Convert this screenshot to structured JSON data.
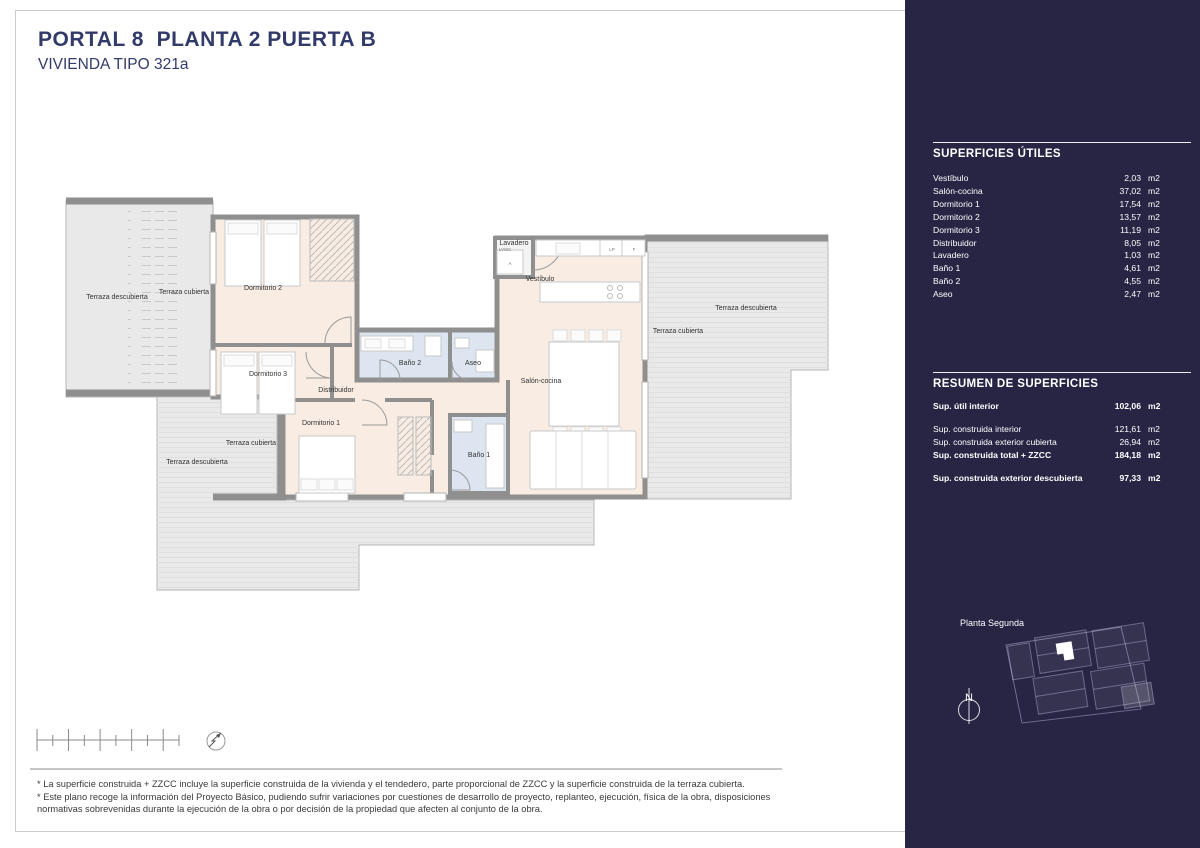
{
  "colors": {
    "navy": "#323a69",
    "sidebar": "#272444",
    "peach": "#f8ece3",
    "wet": "#dce5f0",
    "terrace": "#e9e9e9",
    "wall": "#8f8f8f"
  },
  "header": {
    "title": "PORTAL 8  PLANTA 2 PUERTA B",
    "subtitle": "VIVIENDA TIPO 321a"
  },
  "plan": {
    "room_labels": [
      {
        "id": "terraza-descubierta-nw",
        "text": "Terraza descubierta",
        "x": 117,
        "y": 299
      },
      {
        "id": "terraza-cubierta-nw",
        "text": "Terraza cubierta",
        "x": 184,
        "y": 294
      },
      {
        "id": "dormitorio-2",
        "text": "Dormitorio 2",
        "x": 263,
        "y": 290
      },
      {
        "id": "dormitorio-3",
        "text": "Dormitorio 3",
        "x": 268,
        "y": 376
      },
      {
        "id": "distribuidor",
        "text": "Distribuidor",
        "x": 336,
        "y": 392
      },
      {
        "id": "dormitorio-1",
        "text": "Dormitorio 1",
        "x": 321,
        "y": 425
      },
      {
        "id": "bano-2",
        "text": "Baño 2",
        "x": 410,
        "y": 365
      },
      {
        "id": "aseo",
        "text": "Aseo",
        "x": 473,
        "y": 365
      },
      {
        "id": "bano-1",
        "text": "Baño 1",
        "x": 479,
        "y": 457
      },
      {
        "id": "lavadero",
        "text": "Lavadero",
        "x": 514,
        "y": 245
      },
      {
        "id": "vestibulo",
        "text": "Vestíbulo",
        "x": 540,
        "y": 281
      },
      {
        "id": "salon-cocina",
        "text": "Salón-cocina",
        "x": 541,
        "y": 383
      },
      {
        "id": "terraza-cubierta-e",
        "text": "Terraza cubierta",
        "x": 678,
        "y": 333
      },
      {
        "id": "terraza-descubierta-e",
        "text": "Terraza descubierta",
        "x": 746,
        "y": 310
      },
      {
        "id": "terraza-cubierta-sw",
        "text": "Terraza cubierta",
        "x": 251,
        "y": 445
      },
      {
        "id": "terraza-descubierta-sw",
        "text": "Terraza descubierta",
        "x": 197,
        "y": 464
      }
    ],
    "tiny_labels": [
      {
        "id": "lavadero-sub",
        "text": "LV/SC",
        "x": 505,
        "y": 251
      },
      {
        "id": "washer",
        "text": "A",
        "x": 510,
        "y": 265
      },
      {
        "id": "kitchen-lp",
        "text": "LP",
        "x": 612,
        "y": 251
      },
      {
        "id": "kitchen-f",
        "text": "F",
        "x": 634,
        "y": 251
      }
    ]
  },
  "sidebar": {
    "superficies": {
      "title": "SUPERFICIES ÚTILES",
      "unit": "m2",
      "rows": [
        {
          "label": "Vestíbulo",
          "value": "2,03"
        },
        {
          "label": "Salón-cocina",
          "value": "37,02"
        },
        {
          "label": "Dormitorio 1",
          "value": "17,54"
        },
        {
          "label": "Dormitorio 2",
          "value": "13,57"
        },
        {
          "label": "Dormitorio 3",
          "value": "11,19"
        },
        {
          "label": "Distribuidor",
          "value": "8,05"
        },
        {
          "label": "Lavadero",
          "value": "1,03"
        },
        {
          "label": "Baño 1",
          "value": "4,61"
        },
        {
          "label": "Baño 2",
          "value": "4,55"
        },
        {
          "label": "Aseo",
          "value": "2,47"
        }
      ]
    },
    "resumen": {
      "title": "RESUMEN  DE SUPERFICIES",
      "unit": "m2",
      "rows": [
        {
          "label": "Sup. útil interior",
          "value": "102,06",
          "bold": true,
          "gap": true
        },
        {
          "label": "Sup. construida interior",
          "value": "121,61",
          "bold": false,
          "gap": false
        },
        {
          "label": "Sup. construida exterior cubierta",
          "value": "26,94",
          "bold": false,
          "gap": false
        },
        {
          "label": "Sup. construida total + ZZCC",
          "value": "184,18",
          "bold": true,
          "gap": true
        },
        {
          "label": "Sup. construida exterior descubierta",
          "value": "97,33",
          "bold": true,
          "gap": false
        }
      ]
    },
    "site_plan_label": "Planta Segunda",
    "north_label": "N"
  },
  "footer": {
    "notes": [
      "* La superficie construida + ZZCC incluye la superficie construida de la vivienda y el tendedero, parte proporcional de ZZCC y la superficie construida de la terraza cubierta.",
      "* Este plano recoge la información del Proyecto Básico, pudiendo sufrir variaciones por cuestiones de desarrollo de proyecto, replanteo, ejecución, física de la obra, disposiciones normativas sobrevenidas durante la ejecución de la obra o por decisión de la propiedad que afecten al conjunto de la obra."
    ]
  }
}
